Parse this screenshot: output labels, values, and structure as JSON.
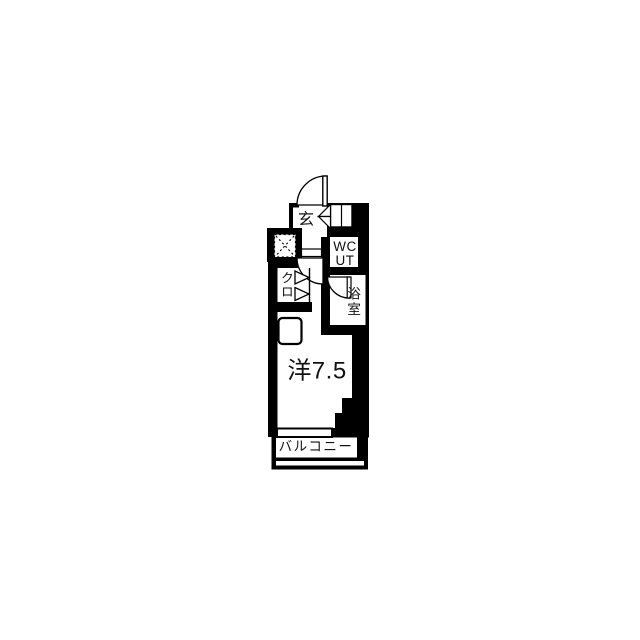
{
  "colors": {
    "wall": "#000000",
    "floor": "#ffffff",
    "ink": "#111111"
  },
  "floorplan": {
    "type": "apartment-floor-plan",
    "labels": {
      "entrance": "玄",
      "wc_line1": "WC",
      "wc_line2": "UT",
      "bathroom": "浴室",
      "closet": "クロ",
      "main_room": "洋7.5",
      "balcony": "バルコニー"
    }
  }
}
